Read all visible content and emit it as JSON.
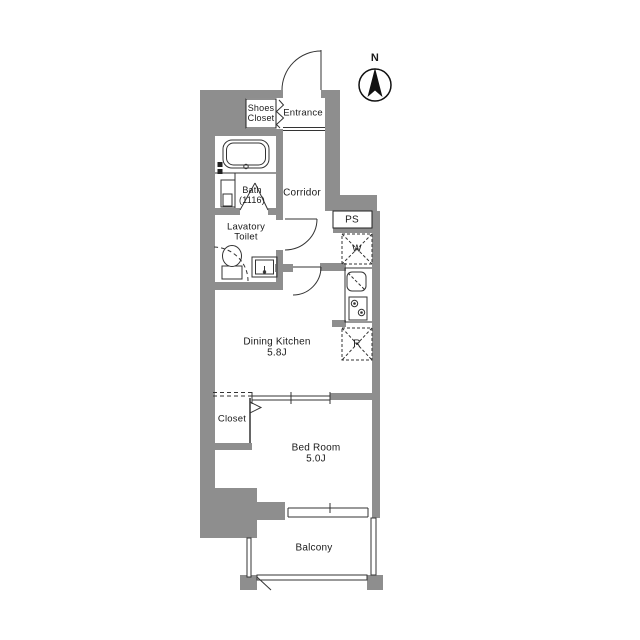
{
  "floorplan": {
    "rooms": {
      "shoes_closet": {
        "line1": "Shoes",
        "line2": "Closet"
      },
      "entrance": {
        "label": "Entrance"
      },
      "bath": {
        "label": "Bath",
        "size": "(1116)"
      },
      "corridor": {
        "label": "Corridor"
      },
      "lavatory": {
        "line1": "Lavatory",
        "line2": "Toilet"
      },
      "pipe_space": {
        "label": "PS"
      },
      "washer": {
        "label": "W"
      },
      "fridge": {
        "label": "R"
      },
      "dining_kitchen": {
        "label": "Dining Kitchen",
        "size": "5.8J"
      },
      "closet": {
        "label": "Closet"
      },
      "bedroom": {
        "label": "Bed Room",
        "size": "5.0J"
      },
      "balcony": {
        "label": "Balcony"
      }
    },
    "compass": {
      "north_label": "N"
    },
    "colors": {
      "wall": "#8e8e8e",
      "line": "#333333",
      "background": "#ffffff"
    }
  }
}
